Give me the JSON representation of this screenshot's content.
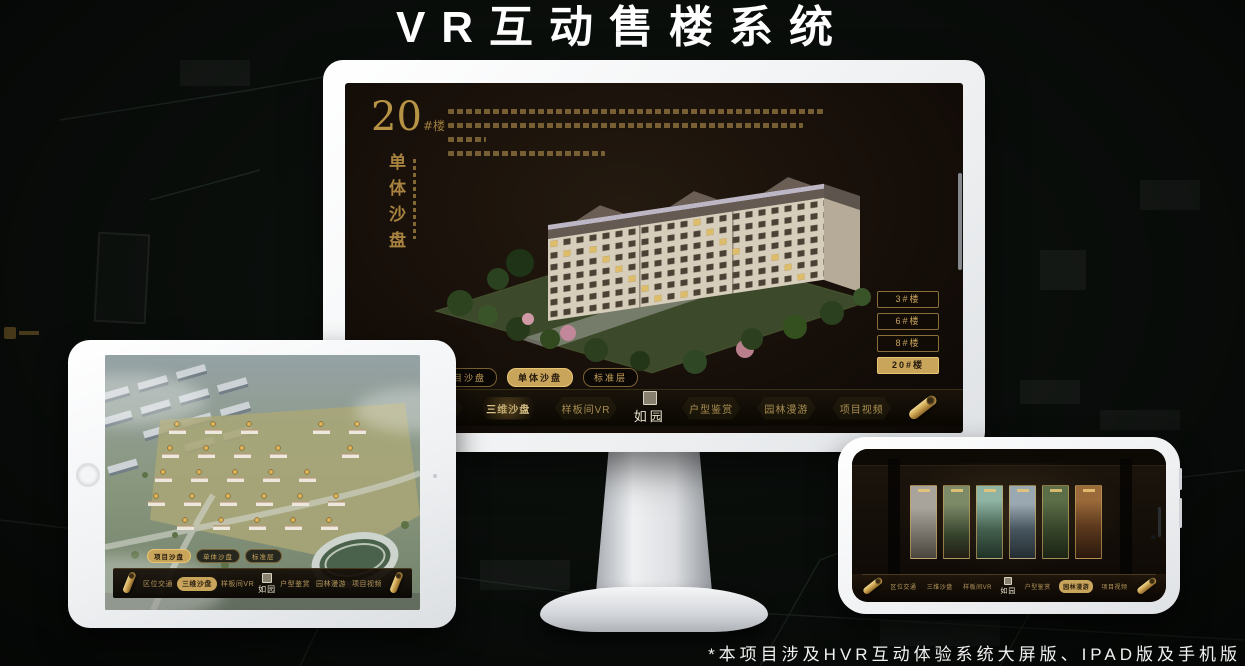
{
  "header": {
    "title": "VR互动售楼系统"
  },
  "footer": {
    "note": "*本项目涉及HVR互动体验系统大屏版、IPAD版及手机版"
  },
  "brand": {
    "name": "如园"
  },
  "nav": {
    "items": [
      {
        "label": "区位交通"
      },
      {
        "label": "三维沙盘"
      },
      {
        "label": "样板间VR"
      },
      {
        "label": "户型鉴赏"
      },
      {
        "label": "园林漫游"
      },
      {
        "label": "项目视频"
      }
    ]
  },
  "view_tabs": [
    {
      "label": "项目沙盘"
    },
    {
      "label": "单体沙盘"
    },
    {
      "label": "标准层"
    }
  ],
  "monitor": {
    "title_number": "20",
    "title_suffix": "#楼",
    "subtitle_vertical": "单体沙盘",
    "active_tab": "单体沙盘",
    "active_nav": "三维沙盘",
    "active_floor": "20#楼",
    "floor_buttons": [
      {
        "label": "3#楼"
      },
      {
        "label": "6#楼"
      },
      {
        "label": "8#楼"
      },
      {
        "label": "20#楼"
      }
    ]
  },
  "tablet": {
    "active_tab": "项目沙盘",
    "active_nav": "三维沙盘"
  },
  "phone": {
    "active_nav": "园林漫游"
  },
  "colors": {
    "gold": "#c9a45b",
    "gold_bright": "#e8c573",
    "screen_bg": "#17110a",
    "canvas_bg": "#0a0e0b",
    "white": "#ffffff"
  }
}
